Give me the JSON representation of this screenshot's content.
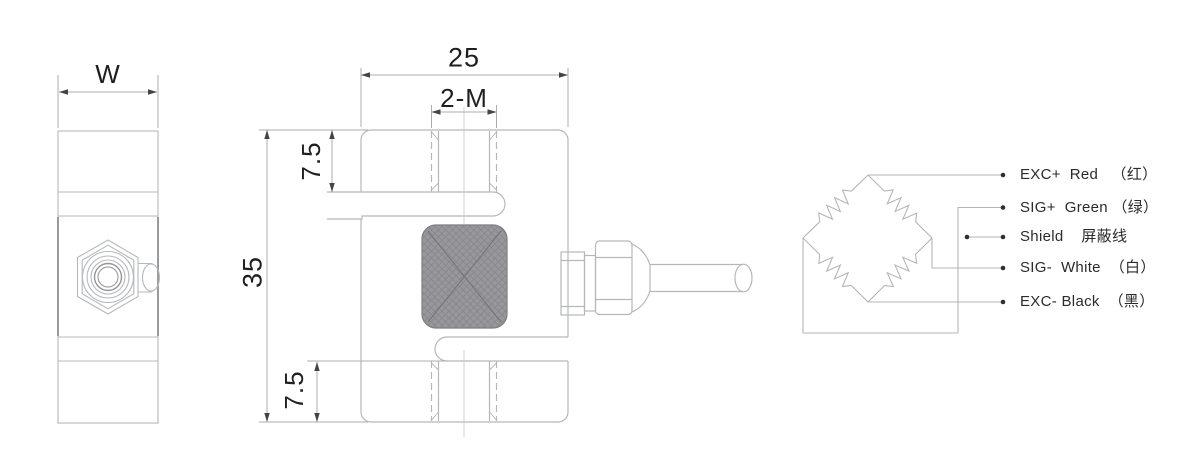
{
  "side_view": {
    "dim_w": "W"
  },
  "front_view": {
    "dim_width": "25",
    "dim_thread": "2-M",
    "dim_top_offset": "7.5",
    "dim_height": "35",
    "dim_bottom_offset": "7.5"
  },
  "wiring": {
    "rows": [
      {
        "signal": "EXC+",
        "wire_color": "Red",
        "cn": "（红）",
        "label": "EXC+  Red   （红）"
      },
      {
        "signal": "SIG+",
        "wire_color": "Green",
        "cn": "（绿）",
        "label": "SIG+  Green （绿）"
      },
      {
        "signal": "Shield",
        "wire_color": "",
        "cn": "屏蔽线",
        "label": "Shield    屏蔽线"
      },
      {
        "signal": "SIG-",
        "wire_color": "White",
        "cn": "（白）",
        "label": "SIG-  White  （白）"
      },
      {
        "signal": "EXC-",
        "wire_color": "Black",
        "cn": "（黑）",
        "label": "EXC- Black  （黑）"
      }
    ]
  },
  "colors": {
    "drawing_line": "#b5b8ba",
    "dimension_line": "#aaadb0",
    "arrow": "#444444",
    "text": "#1f1f1f",
    "gauge_fill": "#98989a"
  }
}
